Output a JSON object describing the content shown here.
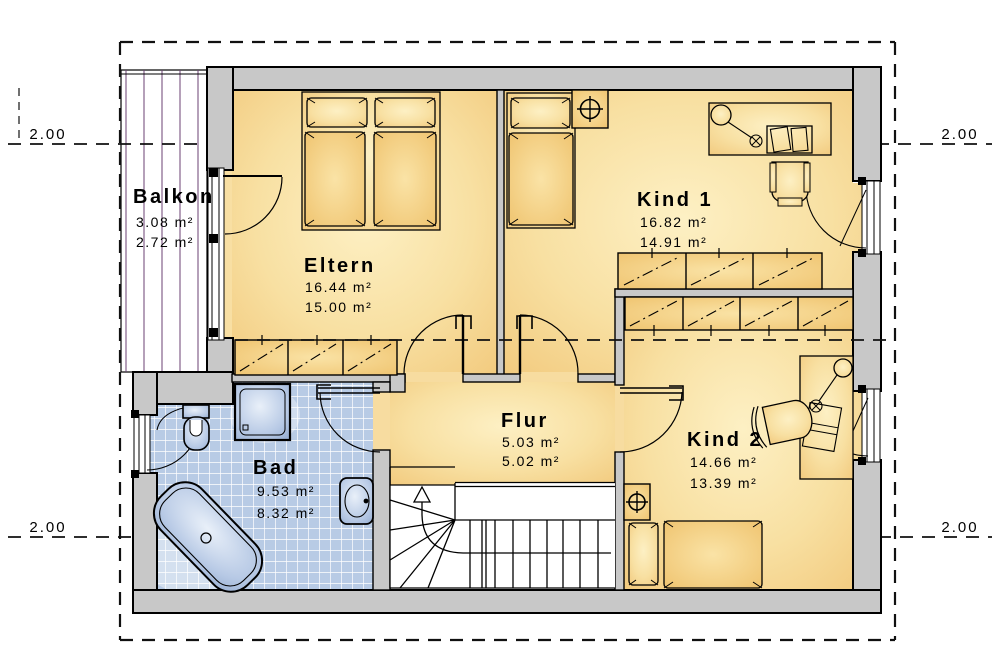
{
  "title": "Dachgeschoss Grundriss",
  "rooms": {
    "balkon": {
      "name": "Balkon",
      "area_gross": "3.08 m²",
      "area_net": "2.72 m²"
    },
    "eltern": {
      "name": "Eltern",
      "area_gross": "16.44 m²",
      "area_net": "15.00 m²"
    },
    "kind1": {
      "name": "Kind 1",
      "area_gross": "16.82 m²",
      "area_net": "14.91 m²"
    },
    "kind2": {
      "name": "Kind 2",
      "area_gross": "14.66 m²",
      "area_net": "13.39 m²"
    },
    "flur": {
      "name": "Flur",
      "area_gross": "5.03 m²",
      "area_net": "5.02 m²"
    },
    "bad": {
      "name": "Bad",
      "area_gross": "9.53 m²",
      "area_net": "8.32 m²"
    }
  },
  "dimensions": {
    "top_left": "2.00",
    "top_right": "2.00",
    "bottom_left": "2.00",
    "bottom_right": "2.00"
  },
  "icons": {
    "chimney_kind1": "circle-cross-chimney",
    "chimney_kind2": "circle-cross-chimney",
    "stair_direction": "up-arrow",
    "desk_lamps": "lamp-circle-with-bulb"
  },
  "colors": {
    "wall_gray": "#c8c8c8",
    "outline_black": "#000000",
    "floor_orange_light": "#fdf0c4",
    "floor_orange_deep": "#f2ca7e",
    "wardrobe_orange": "#efc26f",
    "tile_blue": "#b8cbe5",
    "fixture_blue": "#8fa8ce",
    "balcony_plank_line": "#6b4273",
    "stair_white": "#ffffff"
  }
}
